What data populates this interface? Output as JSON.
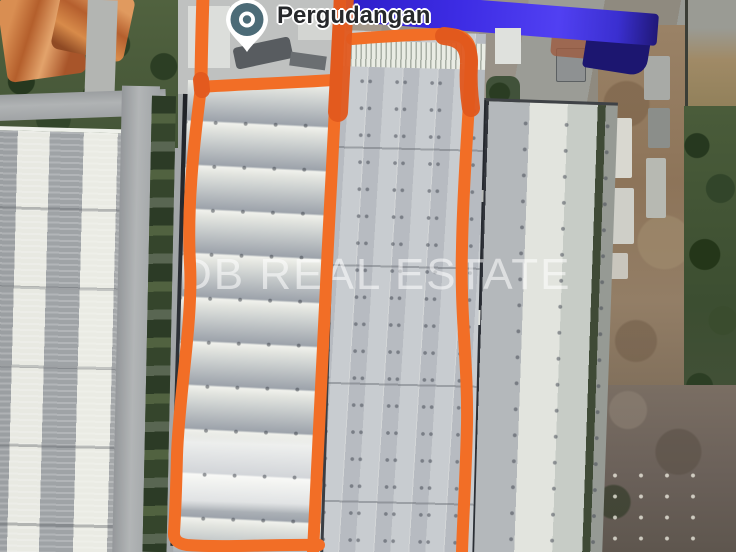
{
  "map": {
    "view": "satellite-imagery",
    "place_pin": {
      "label": "Pergudangan",
      "icon": "place-pin-icon",
      "pin_color": "#4c6b77"
    },
    "watermark": {
      "text": "DB REAL ESTATE",
      "color": "#ffffff"
    },
    "annotation": {
      "color": "#f26e26",
      "color_dark": "#e2581d",
      "shapes": [
        "left-parcel-outline",
        "right-parcel-outline"
      ]
    },
    "colors": {
      "annotation_orange": "#f26e26",
      "blue_roof": "#3d2ce4",
      "pin_teal": "#4c6b77"
    }
  }
}
